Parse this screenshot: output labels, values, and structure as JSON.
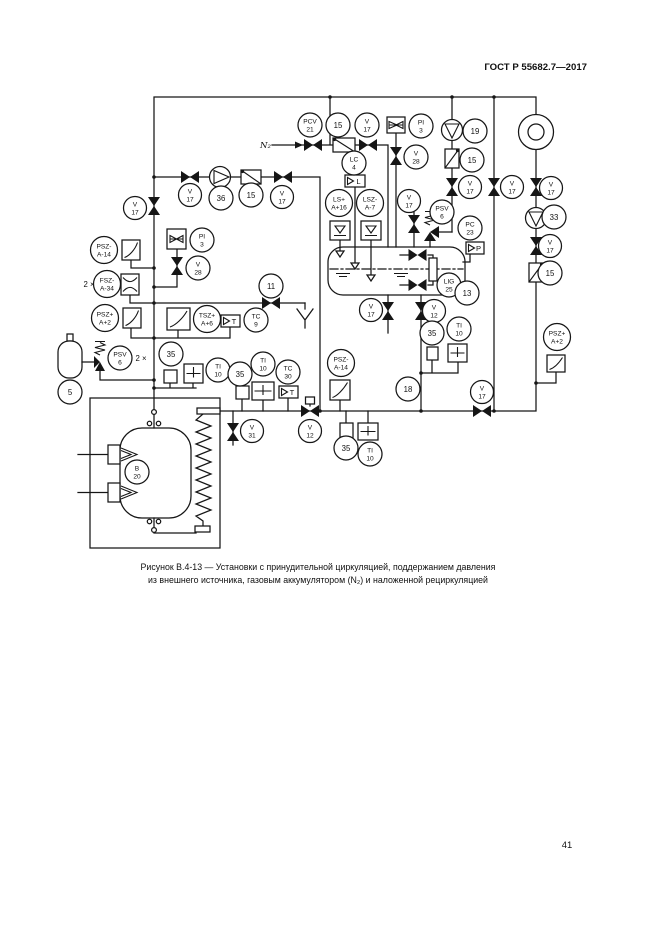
{
  "header": {
    "title": "ГОСТ Р 55682.7—2017"
  },
  "footer": {
    "page_number": "41"
  },
  "caption": {
    "line1": "Рисунок В.4-13 — Установки с принудительной циркуляцией, поддержанием давления",
    "line2": "из внешнего источника, газовым аккумулятором (N₂) и наложенной рециркуляцией"
  },
  "labels": {
    "n2": "N₂",
    "fsz_qty": "2 ×",
    "psv_qty": "2 ×"
  },
  "displays": {
    "level_letter": "L",
    "temp9_letter": "T",
    "temp30_letter": "T",
    "pressure_letter": "P"
  },
  "bubbles": [
    {
      "l1": "PCV",
      "l2": "21"
    },
    {
      "l1": "15"
    },
    {
      "l1": "V",
      "l2": "17"
    },
    {
      "l1": "PI",
      "l2": "3"
    },
    {
      "l1": "19"
    },
    {
      "l1": "V",
      "l2": "28"
    },
    {
      "l1": "LC",
      "l2": "4"
    },
    {
      "l1": "15"
    },
    {
      "l1": "LS+",
      "l2": "A+16"
    },
    {
      "l1": "LSZ-",
      "l2": "A-7"
    },
    {
      "l1": "V",
      "l2": "17"
    },
    {
      "l1": "V",
      "l2": "17"
    },
    {
      "l1": "V",
      "l2": "17"
    },
    {
      "l1": "33"
    },
    {
      "l1": "V",
      "l2": "17"
    },
    {
      "l1": "15"
    },
    {
      "l1": "V",
      "l2": "17"
    },
    {
      "l1": "PSV",
      "l2": "6"
    },
    {
      "l1": "PC",
      "l2": "23"
    },
    {
      "l1": "LIG",
      "l2": "25"
    },
    {
      "l1": "13"
    },
    {
      "l1": "V",
      "l2": "17"
    },
    {
      "l1": "V",
      "l2": "17"
    },
    {
      "l1": "36"
    },
    {
      "l1": "15"
    },
    {
      "l1": "V",
      "l2": "17"
    },
    {
      "l1": "PSZ-",
      "l2": "A-14"
    },
    {
      "l1": "PI",
      "l2": "3"
    },
    {
      "l1": "V",
      "l2": "28"
    },
    {
      "l1": "FSZ-",
      "l2": "A-34"
    },
    {
      "l1": "PSZ+",
      "l2": "A+2"
    },
    {
      "l1": "11"
    },
    {
      "l1": "TSZ+",
      "l2": "A+6"
    },
    {
      "l1": "TC",
      "l2": "9"
    },
    {
      "l1": "PSV",
      "l2": "6"
    },
    {
      "l1": "5"
    },
    {
      "l1": "35"
    },
    {
      "l1": "TI",
      "l2": "10"
    },
    {
      "l1": "35"
    },
    {
      "l1": "TI",
      "l2": "10"
    },
    {
      "l1": "TC",
      "l2": "30"
    },
    {
      "l1": "V",
      "l2": "31"
    },
    {
      "l1": "V",
      "l2": "12"
    },
    {
      "l1": "B",
      "l2": "20"
    },
    {
      "l1": "V",
      "l2": "17"
    },
    {
      "l1": "V",
      "l2": "12"
    },
    {
      "l1": "35"
    },
    {
      "l1": "TI",
      "l2": "10"
    },
    {
      "l1": "PSZ-",
      "l2": "A-14"
    },
    {
      "l1": "18"
    },
    {
      "l1": "35"
    },
    {
      "l1": "TI",
      "l2": "10"
    },
    {
      "l1": "V",
      "l2": "17"
    },
    {
      "l1": "PSZ+",
      "l2": "A+2"
    }
  ]
}
